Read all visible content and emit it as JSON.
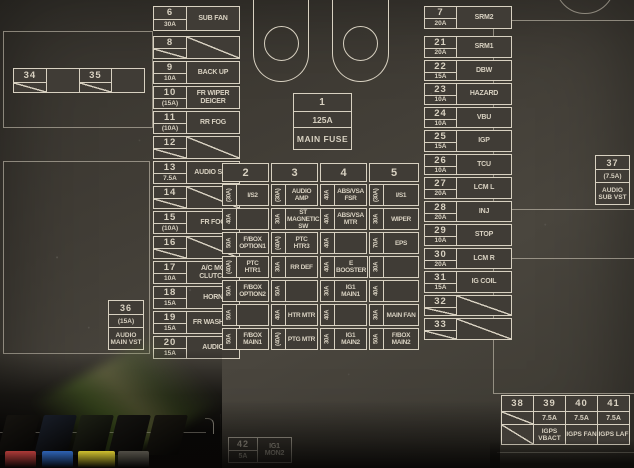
{
  "panel": {
    "line_color": "#d8d1c1",
    "background_color": "#3e3b35"
  },
  "main_fuse": {
    "number": "1",
    "amps": "125A",
    "label": "MAIN FUSE"
  },
  "box36": {
    "number": "36",
    "amps": "(15A)",
    "label": "AUDIO MAIN VST"
  },
  "box37": {
    "number": "37",
    "amps": "(7.5A)",
    "label": "AUDIO SUB VST"
  },
  "box42": {
    "number": "42",
    "amps": "5A",
    "label": "IG1 MON2"
  },
  "relay_strip": {
    "cells": [
      {
        "number": "34"
      },
      {
        "number": ""
      },
      {
        "number": "35"
      },
      {
        "number": ""
      }
    ]
  },
  "left_fuses": [
    {
      "number": "6",
      "amps": "30A",
      "label": "SUB FAN"
    },
    {
      "number": "8",
      "amps": "",
      "label": ""
    },
    {
      "number": "9",
      "amps": "10A",
      "label": "BACK UP"
    },
    {
      "number": "10",
      "amps": "(15A)",
      "label": "FR WIPER DEICER"
    },
    {
      "number": "11",
      "amps": "(10A)",
      "label": "RR FOG"
    },
    {
      "number": "12",
      "amps": "",
      "label": ""
    },
    {
      "number": "13",
      "amps": "7.5A",
      "label": "AUDIO SUB"
    },
    {
      "number": "14",
      "amps": "",
      "label": ""
    },
    {
      "number": "15",
      "amps": "(10A)",
      "label": "FR FOG"
    },
    {
      "number": "16",
      "amps": "",
      "label": ""
    },
    {
      "number": "17",
      "amps": "10A",
      "label": "A/C MG CLUTCH"
    },
    {
      "number": "18",
      "amps": "15A",
      "label": "HORN"
    },
    {
      "number": "19",
      "amps": "15A",
      "label": "FR WASHER"
    },
    {
      "number": "20",
      "amps": "15A",
      "label": "AUDIO"
    }
  ],
  "right_fuses": [
    {
      "number": "7",
      "amps": "20A",
      "label": "SRM2"
    },
    {
      "number": "21",
      "amps": "20A",
      "label": "SRM1"
    },
    {
      "number": "22",
      "amps": "15A",
      "label": "DBW"
    },
    {
      "number": "23",
      "amps": "10A",
      "label": "HAZARD"
    },
    {
      "number": "24",
      "amps": "10A",
      "label": "VBU"
    },
    {
      "number": "25",
      "amps": "15A",
      "label": "IGP"
    },
    {
      "number": "26",
      "amps": "10A",
      "label": "TCU"
    },
    {
      "number": "27",
      "amps": "20A",
      "label": "LCM L"
    },
    {
      "number": "28",
      "amps": "20A",
      "label": "INJ"
    },
    {
      "number": "29",
      "amps": "10A",
      "label": "STOP"
    },
    {
      "number": "30",
      "amps": "20A",
      "label": "LCM R"
    },
    {
      "number": "31",
      "amps": "15A",
      "label": "IG COIL"
    },
    {
      "number": "32",
      "amps": "",
      "label": ""
    },
    {
      "number": "33",
      "amps": "",
      "label": ""
    }
  ],
  "center_columns": [
    {
      "header": "2",
      "rows": [
        {
          "amps": "(30A)",
          "label": "I/S2"
        },
        {
          "amps": "40A",
          "label": ""
        },
        {
          "amps": "50A",
          "label": "F/BOX OPTION1"
        },
        {
          "amps": "(40A)",
          "label": "PTC HTR1"
        },
        {
          "amps": "50A",
          "label": "F/BOX OPTION2"
        },
        {
          "amps": "50A",
          "label": ""
        },
        {
          "amps": "50A",
          "label": "F/BOX MAIN1"
        }
      ]
    },
    {
      "header": "3",
      "rows": [
        {
          "amps": "(30A)",
          "label": "AUDIO AMP"
        },
        {
          "amps": "30A",
          "label": "ST MAGNETIC SW"
        },
        {
          "amps": "(40A)",
          "label": "PTC HTR3"
        },
        {
          "amps": "30A",
          "label": "RR DEF"
        },
        {
          "amps": "50A",
          "label": ""
        },
        {
          "amps": "40A",
          "label": "HTR MTR"
        },
        {
          "amps": "(40A)",
          "label": "PTG MTR"
        }
      ]
    },
    {
      "header": "4",
      "rows": [
        {
          "amps": "40A",
          "label": "ABS/VSA FSR"
        },
        {
          "amps": "40A",
          "label": "ABS/VSA MTR"
        },
        {
          "amps": "40A",
          "label": ""
        },
        {
          "amps": "40A",
          "label": "E BOOSTER"
        },
        {
          "amps": "30A",
          "label": "IG1 MAIN1"
        },
        {
          "amps": "40A",
          "label": ""
        },
        {
          "amps": "30A",
          "label": "IG1 MAIN2"
        }
      ]
    },
    {
      "header": "5",
      "rows": [
        {
          "amps": "(30A)",
          "label": "I/S1"
        },
        {
          "amps": "30A",
          "label": "WIPER"
        },
        {
          "amps": "70A",
          "label": "EPS"
        },
        {
          "amps": "30A",
          "label": ""
        },
        {
          "amps": "40A",
          "label": ""
        },
        {
          "amps": "30A",
          "label": "MAIN FAN"
        },
        {
          "amps": "50A",
          "label": "F/BOX MAIN2"
        }
      ]
    }
  ],
  "bottom_right_table": {
    "columns": [
      {
        "number": "38",
        "amps": "",
        "label": ""
      },
      {
        "number": "39",
        "amps": "7.5A",
        "label": "IGPS VBACT"
      },
      {
        "number": "40",
        "amps": "7.5A",
        "label": "IGPS FAN"
      },
      {
        "number": "41",
        "amps": "7.5A",
        "label": "IGPS LAF"
      }
    ]
  },
  "physical_fuses": {
    "cap_colors": [
      "#ad3a38",
      "#2e63b4",
      "#cfc02f",
      "#514e46"
    ],
    "glow_color": "#9ccf4a"
  }
}
